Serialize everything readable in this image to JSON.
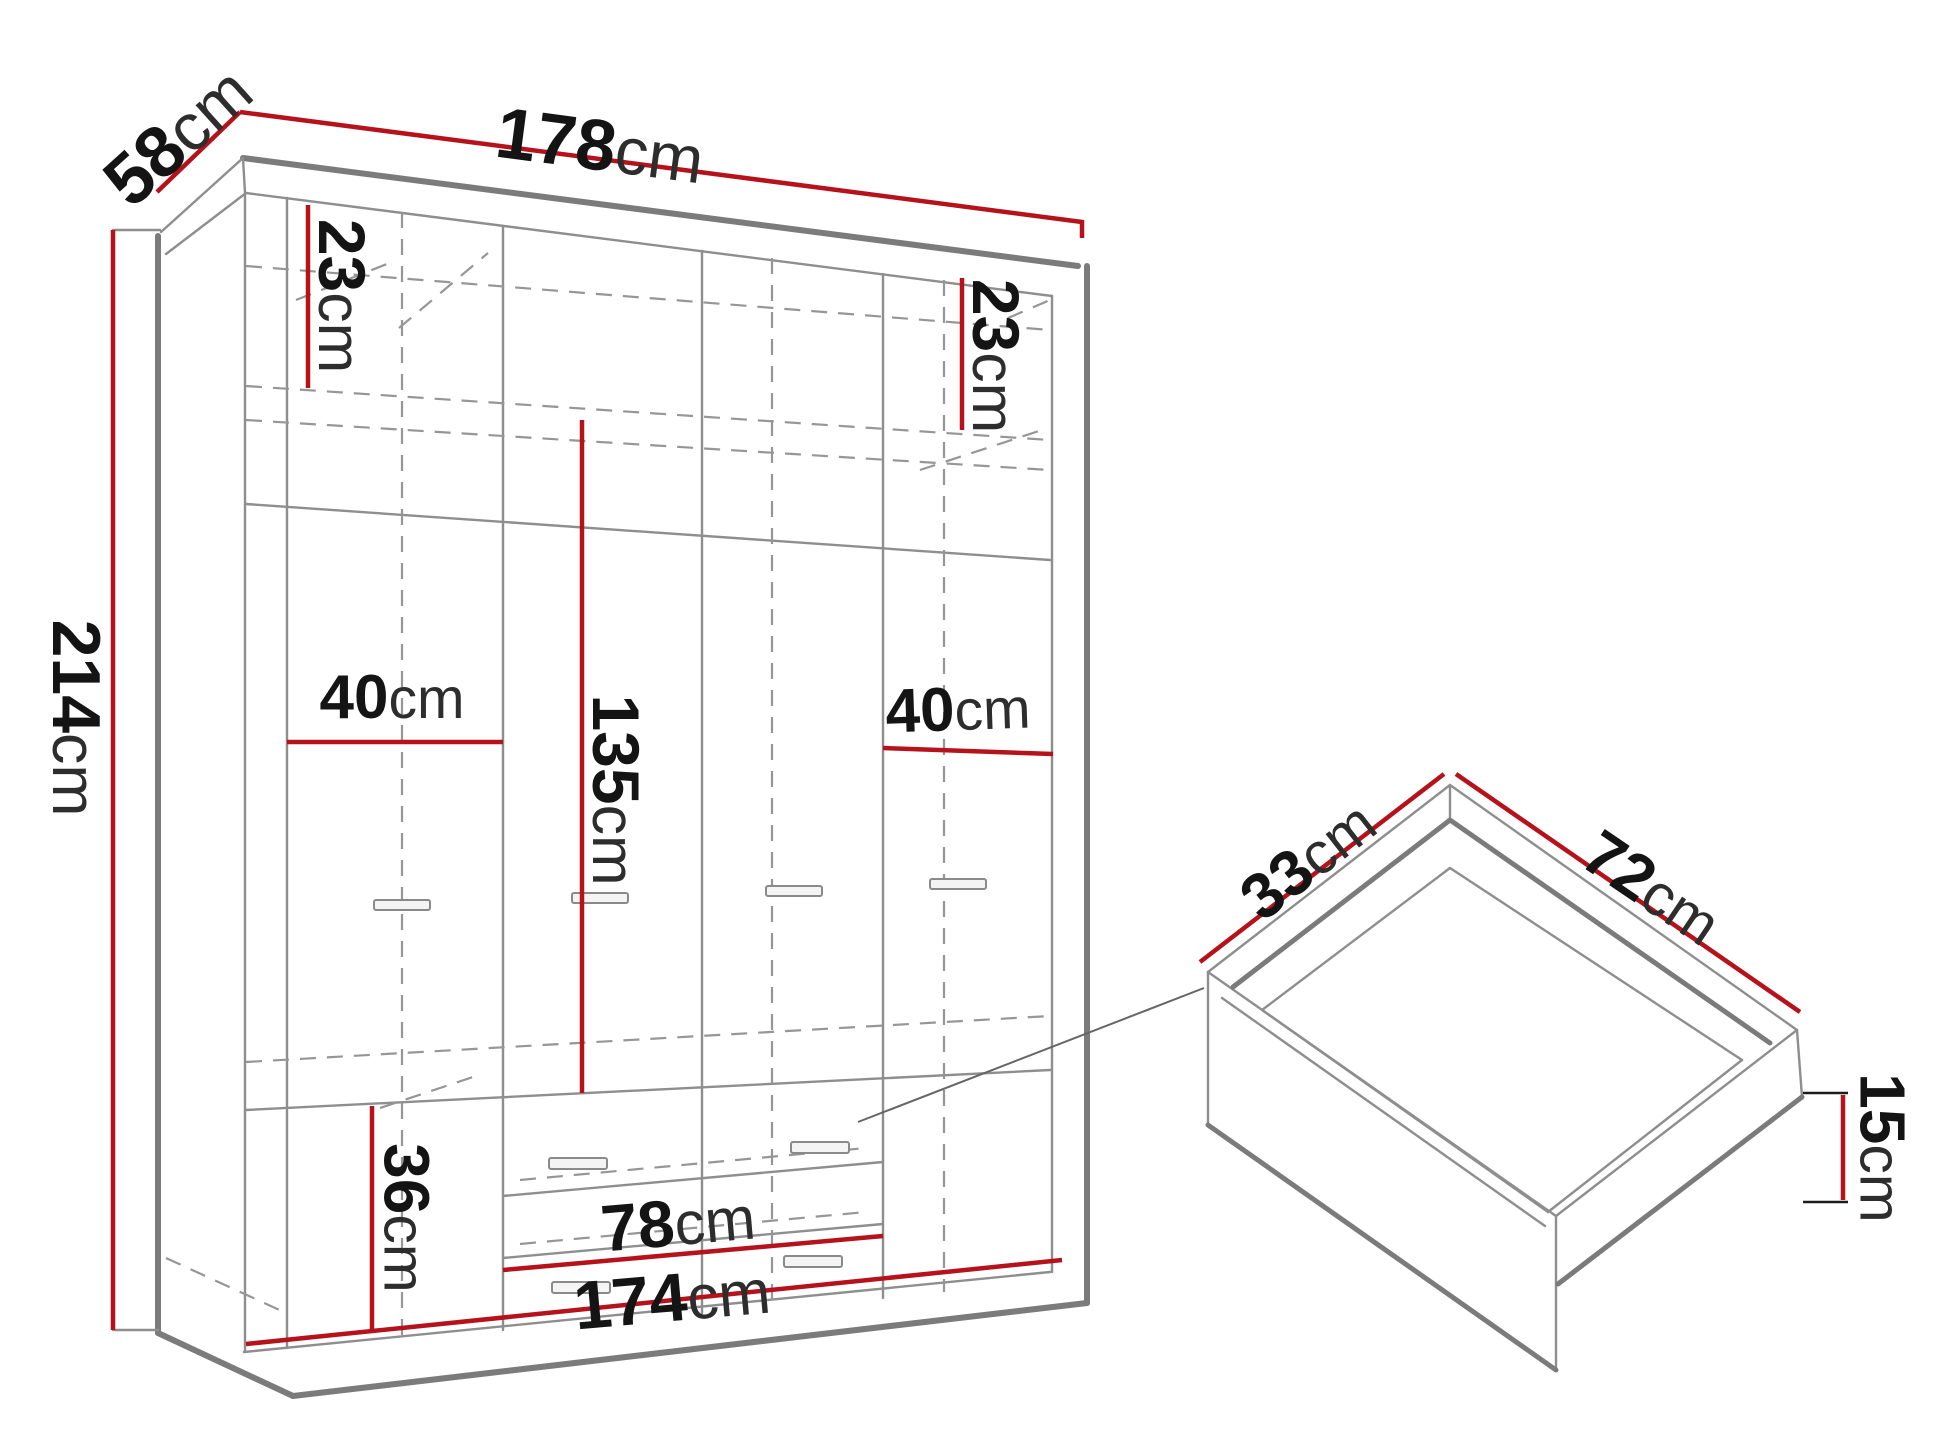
{
  "figure": {
    "type": "furniture-dimension-diagram",
    "background": "#ffffff",
    "accent_red": "#b5121b",
    "outline_gray": "#7b7b7b",
    "thin_gray": "#8e8e8e",
    "dash_gray": "#969696",
    "text_black": "#141414"
  },
  "wardrobe": {
    "name": "wardrobe-front-view",
    "dims": {
      "w178": {
        "value": "178",
        "unit": "cm"
      },
      "d58": {
        "value": "58",
        "unit": "cm"
      },
      "h214": {
        "value": "214",
        "unit": "cm"
      },
      "c23l": {
        "value": "23",
        "unit": "cm"
      },
      "c23r": {
        "value": "23",
        "unit": "cm"
      },
      "w40l": {
        "value": "40",
        "unit": "cm"
      },
      "h135": {
        "value": "135",
        "unit": "cm"
      },
      "w40r": {
        "value": "40",
        "unit": "cm"
      },
      "h36": {
        "value": "36",
        "unit": "cm"
      },
      "w78": {
        "value": "78",
        "unit": "cm"
      },
      "w174": {
        "value": "174",
        "unit": "cm"
      }
    }
  },
  "drawer": {
    "name": "drawer-detail-view",
    "dims": {
      "d33": {
        "value": "33",
        "unit": "cm"
      },
      "w72": {
        "value": "72",
        "unit": "cm"
      },
      "h15": {
        "value": "15",
        "unit": "cm"
      }
    }
  }
}
